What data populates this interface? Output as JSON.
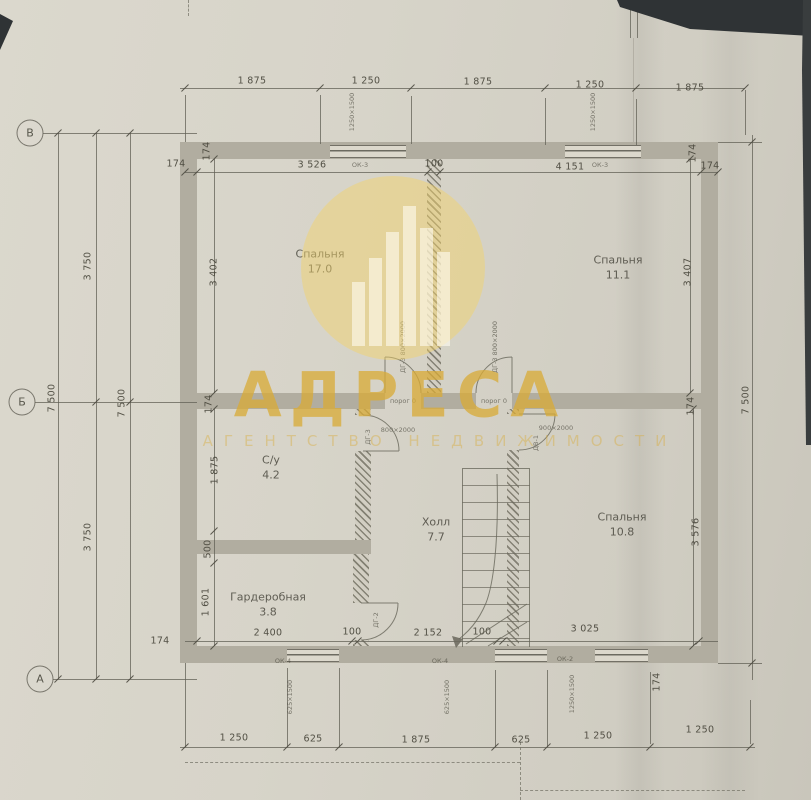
{
  "axes": {
    "top": "В",
    "middle": "Б",
    "bottom": "А"
  },
  "watermark": {
    "brand": "АДРЕСА",
    "subtitle": "АГЕНТСТВО НЕДВИЖИМОСТИ"
  },
  "rooms": {
    "bedroom1": {
      "name": "Спальня",
      "area": "17.0"
    },
    "bedroom2": {
      "name": "Спальня",
      "area": "11.1"
    },
    "bathroom": {
      "name": "С/у",
      "area": "4.2"
    },
    "hall": {
      "name": "Холл",
      "area": "7.7"
    },
    "bedroom3": {
      "name": "Спальня",
      "area": "10.8"
    },
    "wardrobe": {
      "name": "Гардеробная",
      "area": "3.8"
    }
  },
  "dims": {
    "top_outer": [
      "1 875",
      "1 250",
      "1 875",
      "1 250",
      "1 875"
    ],
    "top_inner": [
      "174",
      "3 526",
      "100",
      "4 151",
      "174"
    ],
    "left": {
      "total": "7 500",
      "segments": [
        "3 750",
        "3 750"
      ],
      "total2": "7 500"
    },
    "right_total": "7 500",
    "left_wall": [
      "174",
      "3 402",
      "174",
      "1 875",
      "500",
      "1 601"
    ],
    "right_wall": [
      "174",
      "3 407",
      "174",
      "3 576"
    ],
    "bottom_inner": [
      "174",
      "2 400",
      "100",
      "2 152",
      "100",
      "3 025",
      "174"
    ],
    "bottom_outer": [
      "1 250",
      "625",
      "1 875",
      "625",
      "1 250",
      "1 250"
    ]
  },
  "annotations": {
    "thresholds": [
      "порог 0",
      "порог 0"
    ],
    "doors": [
      {
        "tag": "ДГ-3",
        "size": "800×2000"
      },
      {
        "tag": "ДГ-3",
        "size": "800×2000"
      },
      {
        "tag": "ДГ-3",
        "size": "800×2000"
      },
      {
        "tag": "ДВ-1",
        "size": "900×2000"
      },
      {
        "tag": "ДГ-2",
        "size": "800×2000"
      }
    ],
    "windows": [
      {
        "tag": "ОК-3",
        "size": "1250×1500"
      },
      {
        "tag": "ОК-3",
        "size": "1250×1500"
      },
      {
        "tag": "ОК-4",
        "size": "625×1500"
      },
      {
        "tag": "ОК-4",
        "size": "625×1500"
      },
      {
        "tag": "ОК-2",
        "size": "1250×1500"
      }
    ]
  }
}
